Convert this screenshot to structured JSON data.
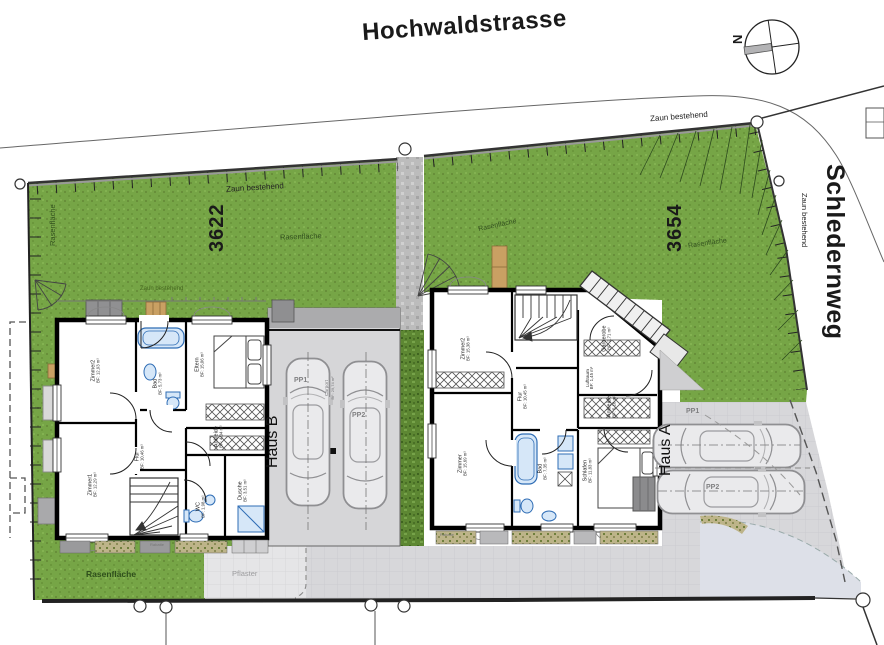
{
  "streets": {
    "top": "Hochwaldstrasse",
    "right": "Schledernweg"
  },
  "compass": {
    "north": "N"
  },
  "parcels": {
    "left": "3622",
    "right": "3654"
  },
  "labels": {
    "fence": "Zaun bestehend",
    "lawn": "Rasenfläche",
    "paving": "Pflaster",
    "planting": "Rabatte"
  },
  "haus_b": {
    "name": "Haus B",
    "rooms": {
      "zimmer2": {
        "name": "Zimmer2",
        "area": "BF: 12,93 m²"
      },
      "bad": {
        "name": "Bad",
        "area": "BF: 5,73 m²"
      },
      "eltern": {
        "name": "Eltern",
        "area": "BF: 15,06 m²"
      },
      "zimmer1": {
        "name": "Zimmer1",
        "area": "BF: 12,29 m²"
      },
      "flur": {
        "name": "Flur",
        "area": "BF: 10,46 m²"
      },
      "wc": {
        "name": "WC",
        "area": "BF: 1,98 m²"
      },
      "ankleide": {
        "name": "Ankleide",
        "area": "BF: 4,04 m²"
      },
      "dusche": {
        "name": "Dusche",
        "area": "BF: 3,51 m²"
      }
    },
    "carport": {
      "name": "Carport",
      "area": "BF: 29,74 m²",
      "pp1": "PP1",
      "pp2": "PP2"
    }
  },
  "haus_a": {
    "name": "Haus A",
    "rooms": {
      "zimmer2": {
        "name": "Zimmer2",
        "area": "BF: 15,38 m²"
      },
      "flur": {
        "name": "Flur",
        "area": "BF: 10,45 m²"
      },
      "garderobe": {
        "name": "Garderobe",
        "area": "BF: 2,71 m²"
      },
      "luftraum": {
        "name": "Luftraum",
        "area": "BF: 1,45 m²"
      },
      "ankleide": {
        "name": "Ankleide",
        "area": "BF: 5,18 m²"
      },
      "zimmer1": {
        "name": "Zimmer",
        "area": "BF: 15,69 m²"
      },
      "bad": {
        "name": "Bad",
        "area": "BF: 7,35 m²"
      },
      "schlafen": {
        "name": "Schlafen",
        "area": "BF: 11,83 m²"
      }
    },
    "parking": {
      "pp1": "PP1",
      "pp2": "PP2"
    }
  }
}
